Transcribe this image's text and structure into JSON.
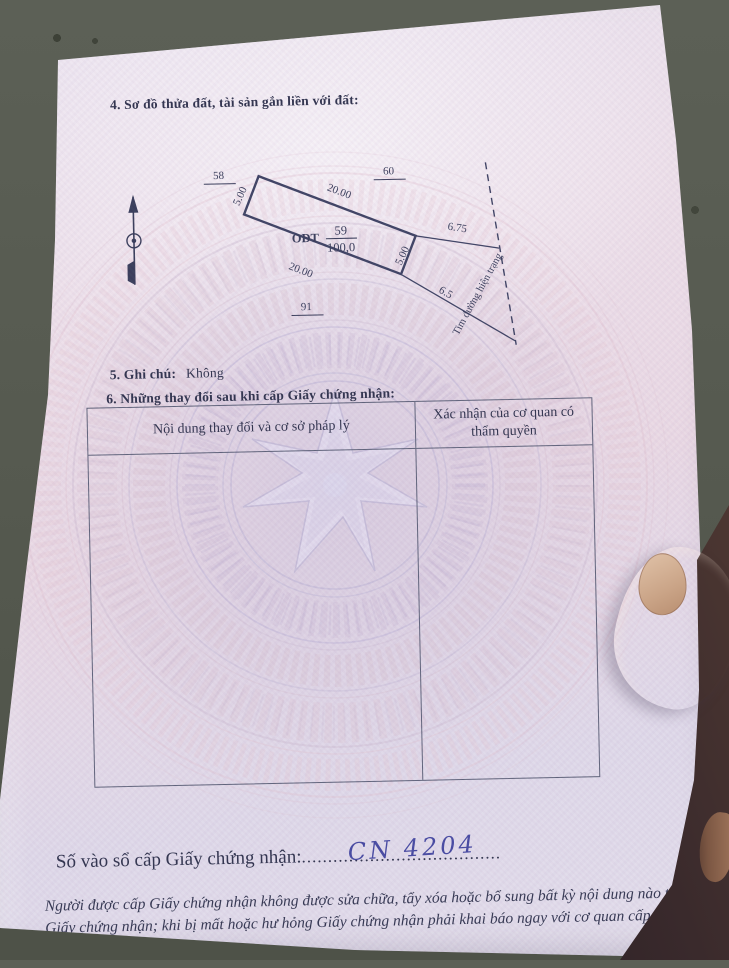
{
  "photo": {
    "setting": "paper certificate page held by a hand over pavement",
    "hand": "thumb pressing right edge of page"
  },
  "colors": {
    "paper_pink": "#ecdfe9",
    "paper_lavender": "#ddd7e8",
    "ink": "#232743",
    "handwriting_blue": "#3b3f9c",
    "watermark_pink": "#dcbccb",
    "watermark_lavender": "#b9b2d4",
    "pavement": "#575b51"
  },
  "document": {
    "section4": {
      "title": "4. Sơ đồ thửa đất, tài sản gắn liền với đất:"
    },
    "section5": {
      "label": "5. Ghi chú:",
      "value": "Không"
    },
    "section6": {
      "title": "6. Những thay đổi sau khi cấp Giấy chứng nhận:",
      "table": {
        "col1_header": "Nội dung thay đổi và cơ sở pháp lý",
        "col2_header": "Xác nhận của cơ quan có thẩm quyền",
        "rows": []
      }
    },
    "registry": {
      "label": "Số vào sổ cấp Giấy chứng nhận:",
      "dots": "......................................",
      "value": "CN 4204"
    },
    "footer_note": "Người được cấp Giấy chứng nhận không được sửa chữa, tẩy xóa hoặc bổ sung bất kỳ nội dung nào trong Giấy chứng nhận; khi bị mất hoặc hư hỏng Giấy chứng nhận phải khai báo ngay với cơ quan cấp Giấy."
  },
  "diagram": {
    "north_arrow": "north-compass-arrow",
    "adjacent_parcel_left": "58",
    "adjacent_parcel_right": "60",
    "adjacent_parcel_bottom": "91",
    "parcel": {
      "land_use_code": "ODT",
      "number": "59",
      "area": "100,0"
    },
    "edge_top": "20.00",
    "edge_bottom": "20.00",
    "edge_left": "5.00",
    "edge_right": "5.00",
    "dist_to_road_top": "6.75",
    "dist_to_road_bottom": "6.5",
    "road_centerline_label": "Tim đường hiện trạng"
  }
}
